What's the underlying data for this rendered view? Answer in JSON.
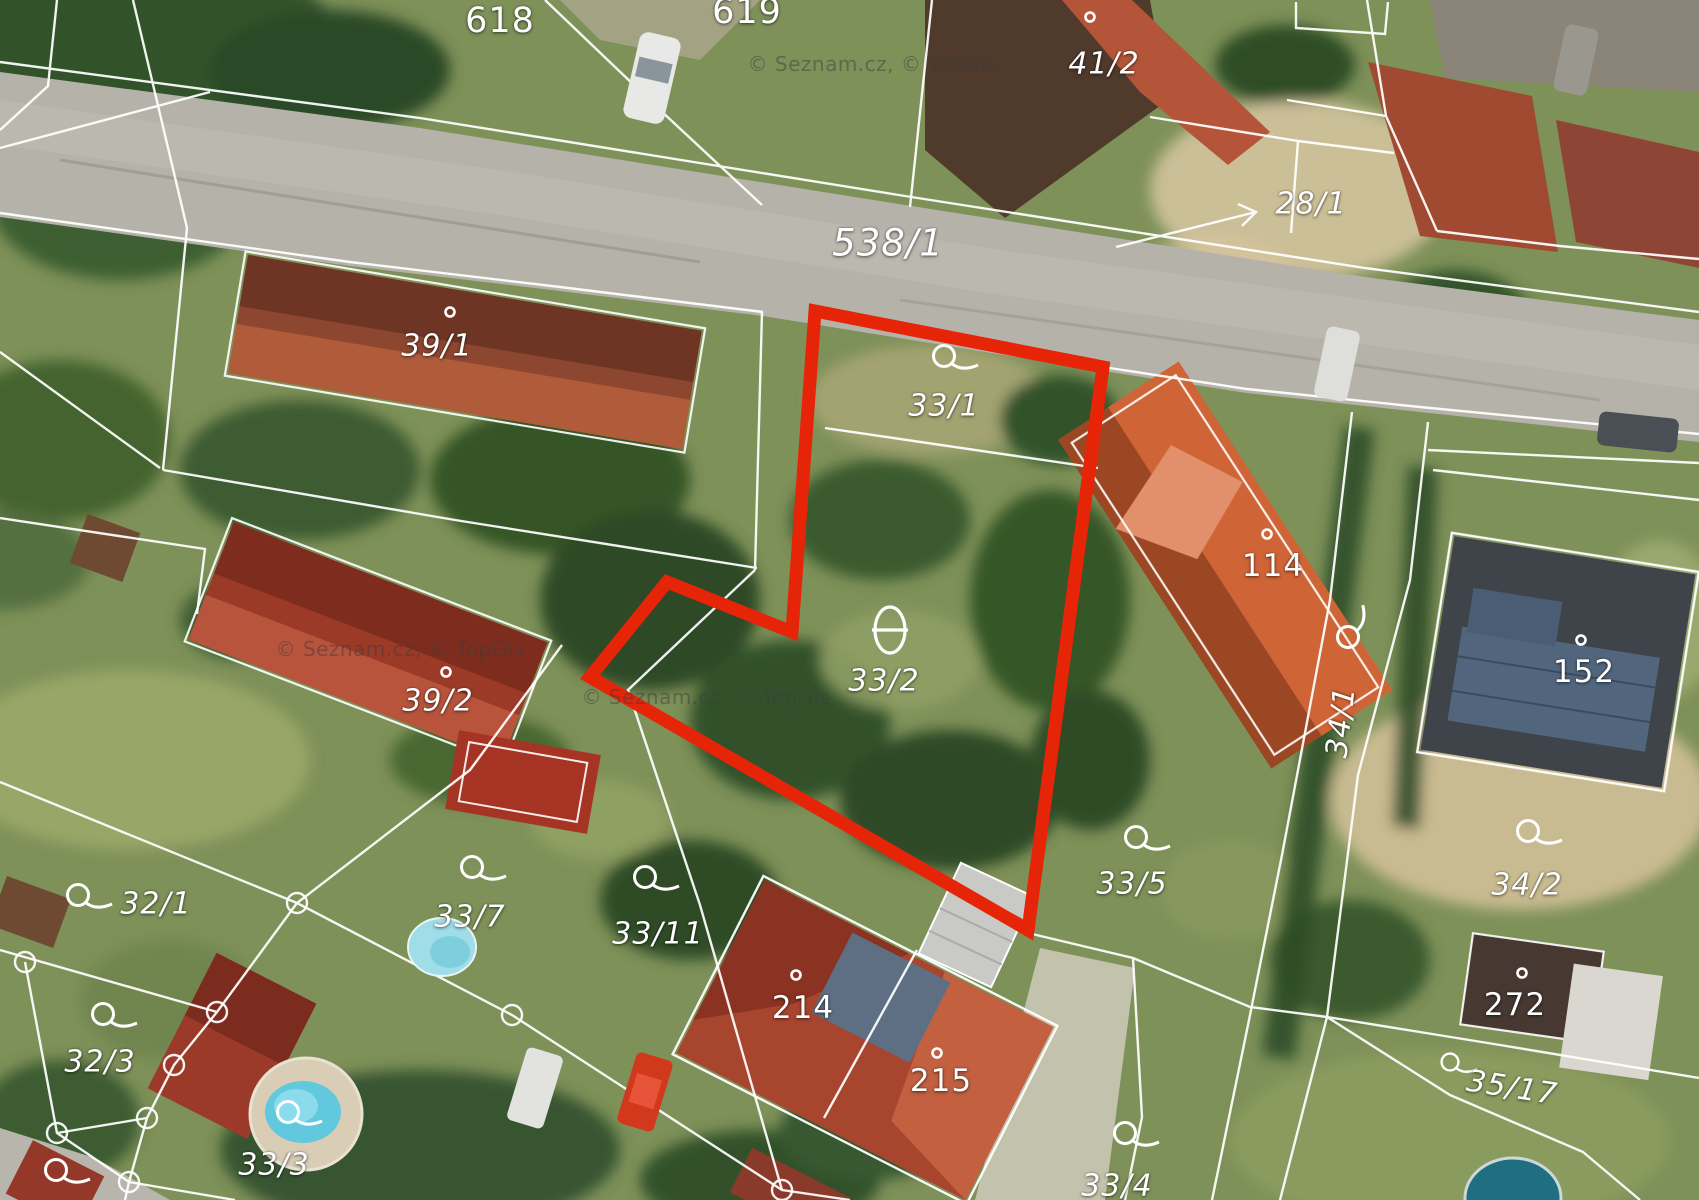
{
  "map": {
    "type": "aerial-cadastral-map",
    "attribution": "© Seznam.cz, © TopGis",
    "highlight_color": "#e52408",
    "boundary_color": "#ffffff"
  },
  "watermarks": [
    {
      "x": 872,
      "y": 64
    },
    {
      "x": 400,
      "y": 649
    },
    {
      "x": 706,
      "y": 697
    }
  ],
  "parcels": [
    {
      "label": "618",
      "kind": "building big",
      "x": 500,
      "y": 21
    },
    {
      "label": "619",
      "kind": "building big",
      "x": 747,
      "y": 12
    },
    {
      "label": "41/2",
      "kind": "land",
      "x": 1104,
      "y": 64,
      "sym": "dot",
      "sx": 1090,
      "sy": 17
    },
    {
      "label": "28/1",
      "kind": "land",
      "x": 1311,
      "y": 204
    },
    {
      "label": "538/1",
      "kind": "road",
      "x": 888,
      "y": 243
    },
    {
      "label": "39/1",
      "kind": "land",
      "x": 437,
      "y": 346,
      "sym": "dot",
      "sx": 450,
      "sy": 312
    },
    {
      "label": "33/1",
      "kind": "land",
      "x": 944,
      "y": 406,
      "sym": "loop",
      "sx": 944,
      "sy": 356
    },
    {
      "label": "114",
      "kind": "building",
      "x": 1273,
      "y": 566,
      "sym": "dot",
      "sx": 1267,
      "sy": 534
    },
    {
      "label": "34/1",
      "kind": "land",
      "x": 1341,
      "y": 722,
      "rot": -83,
      "sym": "loop",
      "sx": 1348,
      "sy": 637,
      "srot": -80
    },
    {
      "label": "152",
      "kind": "building",
      "x": 1584,
      "y": 672,
      "sym": "dot",
      "sx": 1581,
      "sy": 640
    },
    {
      "label": "39/2",
      "kind": "land",
      "x": 438,
      "y": 701,
      "sym": "dot",
      "sx": 446,
      "sy": 672
    },
    {
      "label": "33/2",
      "kind": "land",
      "x": 884,
      "y": 681,
      "sym": "theta",
      "sx": 890,
      "sy": 630
    },
    {
      "label": "33/5",
      "kind": "land",
      "x": 1132,
      "y": 884,
      "sym": "loop",
      "sx": 1136,
      "sy": 837
    },
    {
      "label": "34/2",
      "kind": "land",
      "x": 1527,
      "y": 885,
      "sym": "loop",
      "sx": 1528,
      "sy": 831
    },
    {
      "label": "32/1",
      "kind": "land",
      "x": 156,
      "y": 904,
      "sym": "loop",
      "sx": 78,
      "sy": 895
    },
    {
      "label": "33/7",
      "kind": "land",
      "x": 470,
      "y": 917,
      "sym": "loop",
      "sx": 472,
      "sy": 867
    },
    {
      "label": "33/11",
      "kind": "land",
      "x": 658,
      "y": 934,
      "sym": "loop",
      "sx": 645,
      "sy": 877
    },
    {
      "label": "214",
      "kind": "building",
      "x": 803,
      "y": 1008,
      "sym": "dot",
      "sx": 796,
      "sy": 975
    },
    {
      "label": "215",
      "kind": "building",
      "x": 941,
      "y": 1081,
      "sym": "dot",
      "sx": 937,
      "sy": 1053
    },
    {
      "label": "272",
      "kind": "building",
      "x": 1515,
      "y": 1005,
      "sym": "dot",
      "sx": 1522,
      "sy": 973
    },
    {
      "label": "35/17",
      "kind": "land",
      "x": 1512,
      "y": 1088,
      "rot": 9,
      "sym": "loop",
      "sx": 1450,
      "sy": 1062,
      "sscale": 0.8
    },
    {
      "label": "32/3",
      "kind": "land",
      "x": 100,
      "y": 1062,
      "sym": "loop",
      "sx": 103,
      "sy": 1014
    },
    {
      "label": "33/3",
      "kind": "land",
      "x": 274,
      "y": 1165,
      "sym": "loop",
      "sx": 288,
      "sy": 1112
    },
    {
      "label": "33/4",
      "kind": "land",
      "x": 1117,
      "y": 1186,
      "sym": "loop",
      "sx": 1125,
      "sy": 1133
    },
    {
      "label": "",
      "kind": "land",
      "x": -100,
      "y": -100,
      "sym": "loop",
      "sx": 56,
      "sy": 1170
    }
  ]
}
